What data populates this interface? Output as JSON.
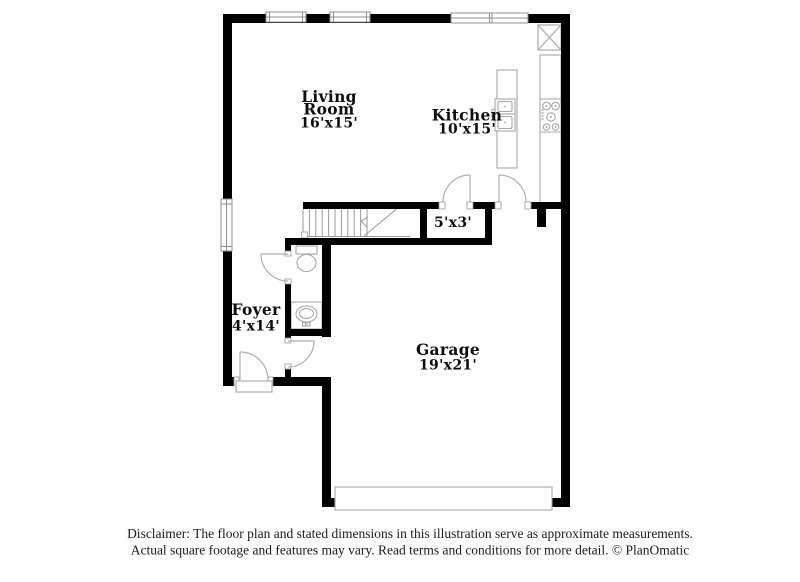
{
  "rooms": {
    "living_room": {
      "name_line1": "Living",
      "name_line2": "Room",
      "dims": "16'x15'"
    },
    "kitchen": {
      "name": "Kitchen",
      "dims": "10'x15'"
    },
    "pantry": {
      "dims": "5'x3'"
    },
    "foyer": {
      "name": "Foyer",
      "dims": "4'x14'"
    },
    "garage": {
      "name": "Garage",
      "dims": "19'x21'"
    }
  },
  "disclaimer": {
    "line1": "Disclaimer: The floor plan and stated dimensions in this illustration serve as approximate measurements.",
    "line2": "Actual square footage and features may vary. Read terms and conditions for more detail. © PlanOmatic"
  },
  "colors": {
    "wall": "#000000",
    "fixture_line": "#a6a6a6",
    "label_text": "#0d0d0d",
    "disclaimer_text": "#1a1a1a",
    "background": "#ffffff"
  }
}
